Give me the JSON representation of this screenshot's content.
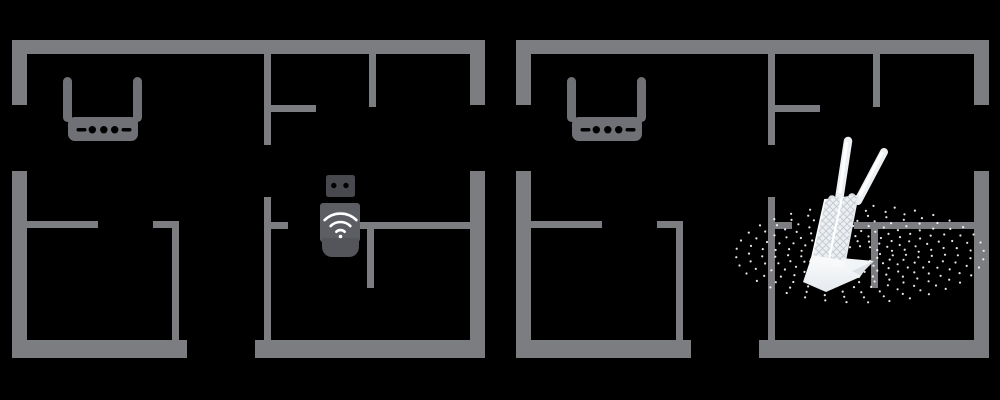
{
  "title": "Wi-Fi adapter coverage comparison floor plans",
  "background": "#000000",
  "colors": {
    "wall": "#7b7d81",
    "router_body": "#6f7176",
    "router_marks": "#000000",
    "usb_plug": "#47494e",
    "usb_body": "#5c5e64",
    "usb_cap": "#53555a",
    "wifi_icon": "#ffffff",
    "adapter_white": "#fbfcfd",
    "adapter_face": "#edf0f3",
    "adapter_shade": "#e6eaee",
    "adapter_shadow": "#dce1e6",
    "adapter_hatch": "#c6ccd3",
    "signal_dots": "#ffffff"
  },
  "panels": [
    {
      "id": "left",
      "label": "floor-plan-with-usb-wifi-adapter",
      "devices": [
        "wifi-router-icon",
        "usb-wifi-adapter-icon"
      ]
    },
    {
      "id": "right",
      "label": "floor-plan-with-external-antenna-wifi-adapter",
      "devices": [
        "wifi-router-icon",
        "external-antenna-wifi-adapter-icon",
        "wifi-coverage-dots"
      ]
    }
  ]
}
